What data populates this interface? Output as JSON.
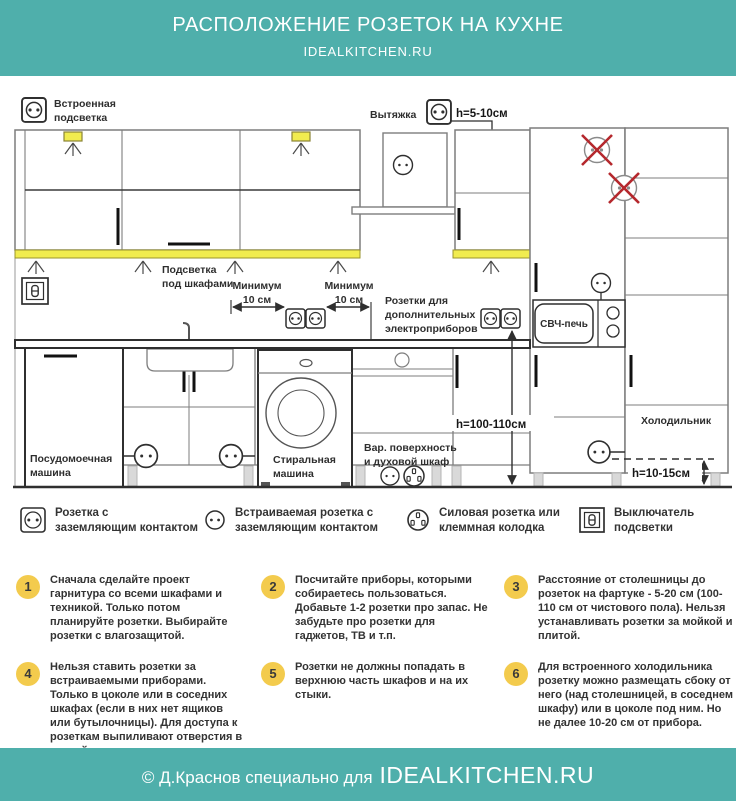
{
  "header": {
    "title": "РАСПОЛОЖЕНИЕ РОЗЕТОК НА КУХНЕ",
    "site": "IDEALKITCHEN.RU"
  },
  "diagram": {
    "labels": {
      "built_in_light_1": "Встроенная",
      "built_in_light_2": "подсветка",
      "hood": "Вытяжка",
      "hood_socket_height": "h=5-10см",
      "under_cabinet_light_1": "Подсветка",
      "under_cabinet_light_2": "под шкафами",
      "min_gap_left_1": "Минимум",
      "min_gap_left_2": "10 см",
      "min_gap_right_1": "Минимум",
      "min_gap_right_2": "10 см",
      "extra_sockets_1": "Розетки для",
      "extra_sockets_2": "дополнительных",
      "extra_sockets_3": "электроприборов",
      "microwave": "СВЧ-печь",
      "dishwasher_1": "Посудомоечная",
      "dishwasher_2": "машина",
      "washer_1": "Стиральная",
      "washer_2": "машина",
      "cooktop_1": "Вар. поверхность",
      "cooktop_2": "и духовой шкаф",
      "splash_socket_height": "h=100-110см",
      "fridge": "Холодильник",
      "fridge_socket_height": "h=10-15см"
    }
  },
  "legend": [
    {
      "icon": "grounded-socket-icon",
      "line1": "Розетка с",
      "line2": "заземляющим контактом"
    },
    {
      "icon": "recessed-socket-icon",
      "line1": "Встраиваемая розетка с",
      "line2": "заземляющим контактом"
    },
    {
      "icon": "power-socket-icon",
      "line1": "Силовая розетка или",
      "line2": "клеммная колодка"
    },
    {
      "icon": "light-switch-icon",
      "line1": "Выключатель",
      "line2": "подсветки"
    }
  ],
  "tips": [
    {
      "number": "1",
      "text": "Сначала сделайте проект гарнитура со всеми шкафами и техникой. Только потом планируйте розетки. Выбирайте розетки с влагозащитой."
    },
    {
      "number": "2",
      "text": "Посчитайте приборы, которыми собираетесь пользоваться. Добавьте 1-2 розетки про запас. Не забудьте про розетки для гаджетов, ТВ и т.п."
    },
    {
      "number": "3",
      "text": "Расстояние от столешницы до розеток на фартуке - 5-20 см (100-110 см от чистового пола). Нельзя устанавливать розетки за мойкой и плитой."
    },
    {
      "number": "4",
      "text": "Нельзя ставить розетки за встраиваемыми приборами. Только в цоколе или в соседних шкафах (если в них нет ящиков или бутылочницы). Для доступа к розеткам выпиливают отверстия в задней стенке."
    },
    {
      "number": "5",
      "text": "Розетки не должны попадать в верхнюю часть шкафов и на их стыки."
    },
    {
      "number": "6",
      "text": "Для встроенного холодильника розетку можно размещать сбоку от него (над столешницей, в соседнем шкафу) или в цоколе под ним. Но не далее 10-20 см от прибора."
    }
  ],
  "footer": {
    "credit": "© Д.Краснов специально для",
    "site": "IDEALKITCHEN.RU"
  },
  "colors": {
    "teal": "#4FAFAB",
    "tip_circle_yellow": "#F3CB4D",
    "light_strip_yellow": "#F1EC4F",
    "warning_red": "#B5282D",
    "line_dark": "#2F2F2F",
    "line_gray": "#8A8A8A"
  }
}
